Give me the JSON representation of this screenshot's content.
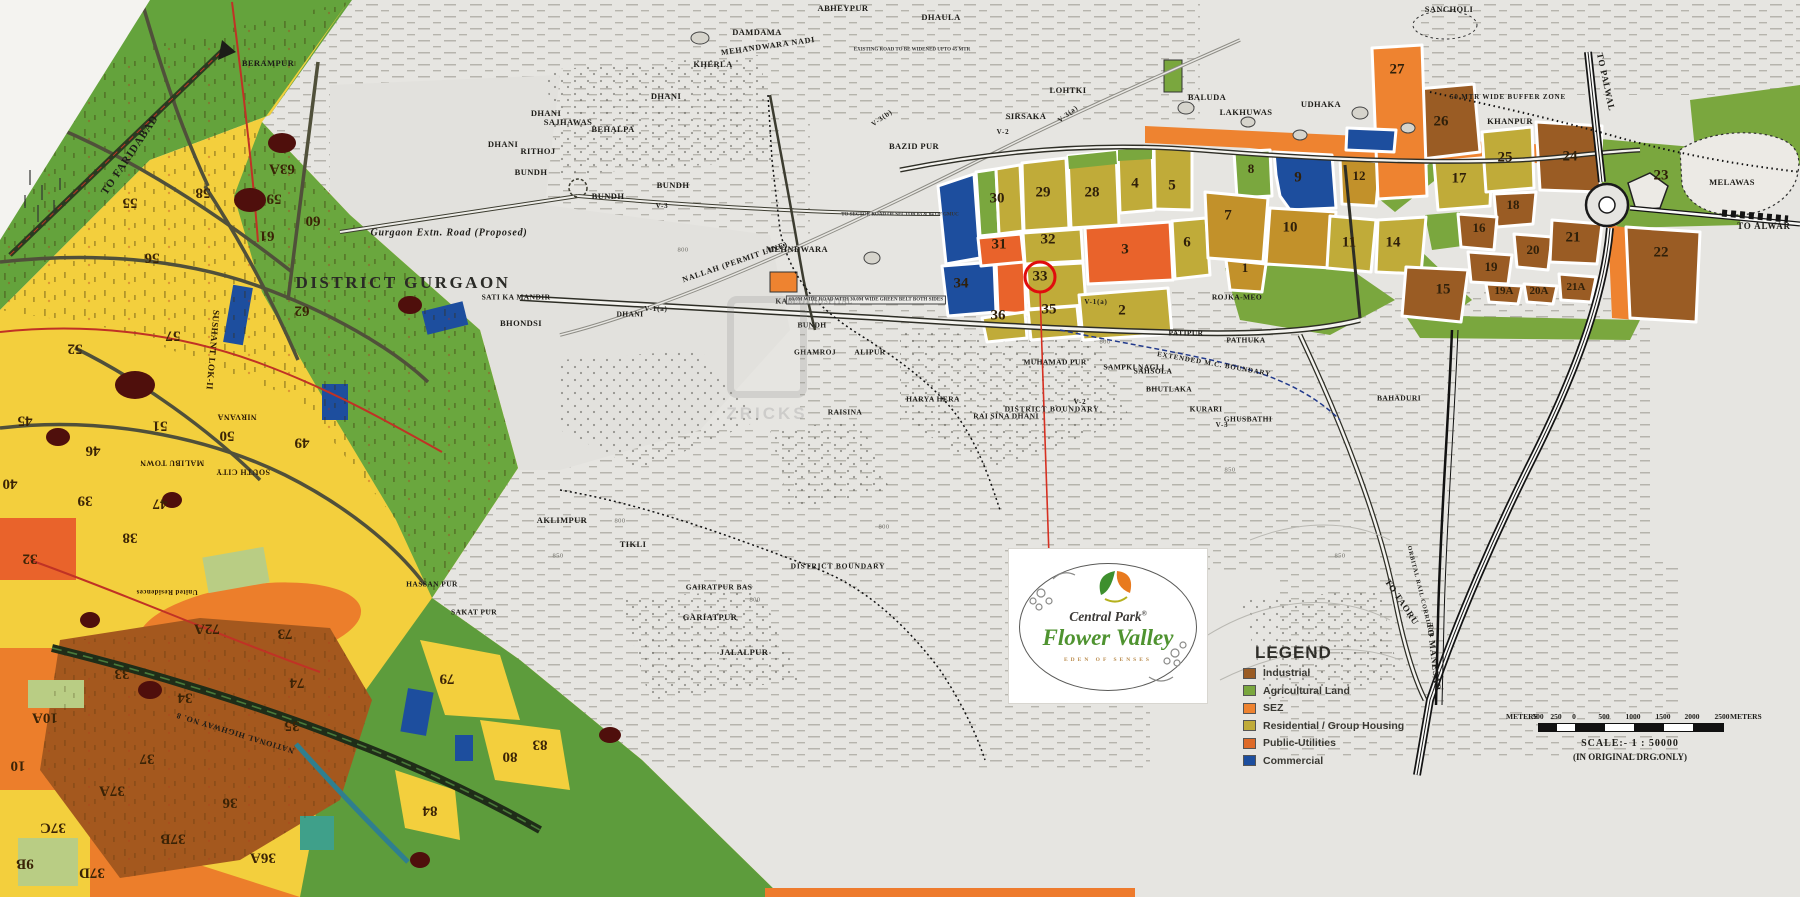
{
  "map_title": "DISTRICT GURGAON",
  "watermark": {
    "text": "ZRICKS"
  },
  "legend": {
    "title": "LEGEND",
    "items": [
      {
        "label": "Industrial",
        "color": "#9a5c24"
      },
      {
        "label": "Agricultural Land",
        "color": "#7aa73e"
      },
      {
        "label": "SEZ",
        "color": "#ee8330"
      },
      {
        "label": "Residential / Group Housing",
        "color": "#c0ab39"
      },
      {
        "label": "Public-Utilities",
        "color": "#de6a28"
      },
      {
        "label": "Commercial",
        "color": "#1d4e9e"
      }
    ]
  },
  "logo": {
    "brand": "Central Park",
    "reg": "®",
    "name": "Flower Valley",
    "tagline": "EDEN OF SENSES"
  },
  "scale_bar": {
    "meters_left": "METERS",
    "meters_right": "METERS",
    "ticks": [
      "500",
      "250",
      "0",
      "500",
      "1000",
      "1500",
      "2000",
      "2500"
    ],
    "tick_x": [
      0,
      18,
      36,
      66,
      95,
      125,
      154,
      184
    ],
    "scale_text": "SCALE:-  1 : 50000",
    "note": "(IN ORIGINAL DRG.ONLY)"
  },
  "boundaries": [
    {
      "t": "DISTRICT GURGAON",
      "x": 403,
      "y": 283,
      "big": true
    },
    {
      "t": "Gurgaon Extn. Road (Proposed)",
      "x": 449,
      "y": 233,
      "fs": 10,
      "ital": true
    },
    {
      "t": "DISTRICT BOUNDARY",
      "x": 1052,
      "y": 409,
      "fs": 7.5
    },
    {
      "t": "DISTRICT BOUNDARY",
      "x": 838,
      "y": 566,
      "fs": 7.5
    },
    {
      "t": "EXTENDED M.C. BOUNDARY",
      "x": 1214,
      "y": 364,
      "fs": 7,
      "r": 10
    },
    {
      "t": "50 MTR WIDE BUFFER ZONE",
      "x": 1508,
      "y": 97,
      "fs": 7
    }
  ],
  "villages": [
    {
      "t": "BERAMPUR",
      "x": 268,
      "y": 63
    },
    {
      "t": "DHANI",
      "x": 666,
      "y": 96
    },
    {
      "t": "KHERLA",
      "x": 713,
      "y": 64
    },
    {
      "t": "DAMDAMA",
      "x": 757,
      "y": 32
    },
    {
      "t": "ABHEYPUR",
      "x": 843,
      "y": 8
    },
    {
      "t": "DHAULA",
      "x": 941,
      "y": 17
    },
    {
      "t": "SANCHOLI",
      "x": 1449,
      "y": 9
    },
    {
      "t": "LOHTKI",
      "x": 1068,
      "y": 90
    },
    {
      "t": "SIRSAKA",
      "x": 1026,
      "y": 116
    },
    {
      "t": "BAZID PUR",
      "x": 914,
      "y": 146
    },
    {
      "t": "DHANI",
      "x": 546,
      "y": 113
    },
    {
      "t": "SAJHAWAS",
      "x": 568,
      "y": 122
    },
    {
      "t": "BEHALPA",
      "x": 613,
      "y": 129
    },
    {
      "t": "RITHOJ",
      "x": 538,
      "y": 151
    },
    {
      "t": "DHANI",
      "x": 503,
      "y": 144
    },
    {
      "t": "BUNDH",
      "x": 531,
      "y": 172
    },
    {
      "t": "BUNDH",
      "x": 608,
      "y": 196
    },
    {
      "t": "BUNDH",
      "x": 673,
      "y": 185
    },
    {
      "t": "MEHNDWARA",
      "x": 797,
      "y": 249
    },
    {
      "t": "KABLIJI HOSPITAL",
      "x": 814,
      "y": 301,
      "fs": 7.5
    },
    {
      "t": "BUNDH",
      "x": 812,
      "y": 325,
      "fs": 7.5
    },
    {
      "t": "DHANI",
      "x": 630,
      "y": 314,
      "fs": 7.5
    },
    {
      "t": "SATI KA MANDIR",
      "x": 516,
      "y": 297,
      "fs": 7.5
    },
    {
      "t": "BHONDSI",
      "x": 521,
      "y": 323
    },
    {
      "t": "GHAMROJ",
      "x": 815,
      "y": 352,
      "fs": 7.5
    },
    {
      "t": "ALIPUR",
      "x": 870,
      "y": 352,
      "fs": 7.5
    },
    {
      "t": "HARYA HERA",
      "x": 933,
      "y": 399,
      "fs": 7.5
    },
    {
      "t": "RAI SINA DHANI",
      "x": 1006,
      "y": 416,
      "fs": 7.5
    },
    {
      "t": "RAISINA",
      "x": 845,
      "y": 412,
      "fs": 7.5
    },
    {
      "t": "MUHAMAD PUR",
      "x": 1055,
      "y": 362,
      "fs": 7.5
    },
    {
      "t": "SAMPKI NAGLI",
      "x": 1134,
      "y": 367,
      "fs": 7.5
    },
    {
      "t": "AKLIMPUR",
      "x": 562,
      "y": 520
    },
    {
      "t": "TIKLI",
      "x": 633,
      "y": 544
    },
    {
      "t": "GAIRATPUR BAS",
      "x": 719,
      "y": 587,
      "fs": 7.5
    },
    {
      "t": "GARIATPUR",
      "x": 710,
      "y": 617
    },
    {
      "t": "JALALPUR",
      "x": 744,
      "y": 652
    },
    {
      "t": "HASSAN PUR",
      "x": 432,
      "y": 584,
      "fs": 7.5
    },
    {
      "t": "SAKAT PUR",
      "x": 474,
      "y": 612,
      "fs": 7.5
    },
    {
      "t": "BALUDA",
      "x": 1207,
      "y": 97
    },
    {
      "t": "LAKHUWAS",
      "x": 1246,
      "y": 112
    },
    {
      "t": "UDHAKA",
      "x": 1321,
      "y": 104
    },
    {
      "t": "KHANPUR",
      "x": 1510,
      "y": 121
    },
    {
      "t": "MELAWAS",
      "x": 1732,
      "y": 182
    },
    {
      "t": "ROJKA-MEO",
      "x": 1237,
      "y": 297,
      "fs": 7.5
    },
    {
      "t": "PATHUKA",
      "x": 1246,
      "y": 340,
      "fs": 7.5
    },
    {
      "t": "PATIPUR",
      "x": 1186,
      "y": 333,
      "fs": 7.5
    },
    {
      "t": "SAHSOLA",
      "x": 1153,
      "y": 371,
      "fs": 7.5
    },
    {
      "t": "BHUTLAKA",
      "x": 1169,
      "y": 389,
      "fs": 7.5
    },
    {
      "t": "KURARI",
      "x": 1206,
      "y": 409,
      "fs": 7.5
    },
    {
      "t": "GHUSBATHI",
      "x": 1248,
      "y": 419,
      "fs": 7.5
    },
    {
      "t": "BAHADURI",
      "x": 1399,
      "y": 398,
      "fs": 7.5
    }
  ],
  "road_labels": [
    {
      "t": "TO FARIDABAD",
      "x": 130,
      "y": 155,
      "r": -56,
      "fs": 11
    },
    {
      "t": "TO PALWAL",
      "x": 1606,
      "y": 82,
      "r": 78
    },
    {
      "t": "TO ALWAR",
      "x": 1764,
      "y": 226
    },
    {
      "t": "TO TAORU",
      "x": 1402,
      "y": 602,
      "r": 56
    },
    {
      "t": "TO MANESAR",
      "x": 1434,
      "y": 657,
      "r": 83
    },
    {
      "t": "ORBITAL RAIL CORRIDOR",
      "x": 1420,
      "y": 592,
      "r": 76,
      "fs": 6
    },
    {
      "t": "NALLAH (PERMIT LINE)",
      "x": 735,
      "y": 262,
      "r": -19,
      "fs": 8
    },
    {
      "t": "MEHANDWARA NADI",
      "x": 768,
      "y": 46,
      "r": -8,
      "fs": 8
    },
    {
      "t": "NATIONAL HIGHWAY NO. 8",
      "x": 235,
      "y": 733,
      "r": 197,
      "fs": 8
    },
    {
      "t": "V-3",
      "x": 662,
      "y": 206,
      "fs": 7
    },
    {
      "t": "V-2",
      "x": 1003,
      "y": 132,
      "fs": 7
    },
    {
      "t": "V-2",
      "x": 1080,
      "y": 402,
      "fs": 7
    },
    {
      "t": "V-3",
      "x": 1222,
      "y": 425,
      "fs": 7
    },
    {
      "t": "V-1(a)",
      "x": 656,
      "y": 309,
      "fs": 7
    },
    {
      "t": "V-1(a)",
      "x": 1096,
      "y": 302,
      "fs": 7
    },
    {
      "t": "V-3(b)",
      "x": 882,
      "y": 118,
      "r": -35,
      "fs": 7
    },
    {
      "t": "V-3(a)",
      "x": 1068,
      "y": 114,
      "r": -38,
      "fs": 7
    }
  ],
  "notes": [
    {
      "t": "EXISTING ROAD TO BE WIDENED UPTO 45 MTR",
      "x": 912,
      "y": 50
    },
    {
      "t": "TO SECTOR ROAD OF SECTOR 63 & 64 OF GMUC",
      "x": 900,
      "y": 215
    },
    {
      "t": "60.0M WIDE ROAD WITH 30.0M WIDE GREEN BELT BOTH SIDES",
      "x": 866,
      "y": 300,
      "boxed": true
    }
  ],
  "contours": [
    {
      "t": "800",
      "x": 683,
      "y": 250
    },
    {
      "t": "800",
      "x": 620,
      "y": 521
    },
    {
      "t": "850",
      "x": 558,
      "y": 556
    },
    {
      "t": "800",
      "x": 884,
      "y": 527
    },
    {
      "t": "800",
      "x": 1105,
      "y": 342
    },
    {
      "t": "850",
      "x": 1340,
      "y": 556
    },
    {
      "t": "850",
      "x": 1230,
      "y": 470
    },
    {
      "t": "800",
      "x": 755,
      "y": 600
    }
  ],
  "sohna_sectors": [
    {
      "n": "30",
      "x": 997,
      "y": 199
    },
    {
      "n": "29",
      "x": 1043,
      "y": 193
    },
    {
      "n": "28",
      "x": 1092,
      "y": 193
    },
    {
      "n": "4",
      "x": 1135,
      "y": 184
    },
    {
      "n": "5",
      "x": 1172,
      "y": 186
    },
    {
      "n": "31",
      "x": 999,
      "y": 245
    },
    {
      "n": "32",
      "x": 1048,
      "y": 240
    },
    {
      "n": "33",
      "x": 1040,
      "y": 277,
      "circled": true
    },
    {
      "n": "3",
      "x": 1125,
      "y": 250
    },
    {
      "n": "6",
      "x": 1187,
      "y": 243
    },
    {
      "n": "34",
      "x": 961,
      "y": 284
    },
    {
      "n": "36",
      "x": 998,
      "y": 316
    },
    {
      "n": "35",
      "x": 1049,
      "y": 310
    },
    {
      "n": "2",
      "x": 1122,
      "y": 311
    },
    {
      "n": "8",
      "x": 1251,
      "y": 169,
      "fs": 13
    },
    {
      "n": "9",
      "x": 1298,
      "y": 178
    },
    {
      "n": "7",
      "x": 1228,
      "y": 216
    },
    {
      "n": "10",
      "x": 1290,
      "y": 228
    },
    {
      "n": "1",
      "x": 1245,
      "y": 268,
      "fs": 13
    },
    {
      "n": "12",
      "x": 1359,
      "y": 176,
      "fs": 13
    },
    {
      "n": "27",
      "x": 1397,
      "y": 70
    },
    {
      "n": "26",
      "x": 1441,
      "y": 122
    },
    {
      "n": "25",
      "x": 1505,
      "y": 158
    },
    {
      "n": "24",
      "x": 1570,
      "y": 157
    },
    {
      "n": "23",
      "x": 1661,
      "y": 176
    },
    {
      "n": "17",
      "x": 1459,
      "y": 179
    },
    {
      "n": "18",
      "x": 1513,
      "y": 205,
      "fs": 13
    },
    {
      "n": "16",
      "x": 1479,
      "y": 228,
      "fs": 13
    },
    {
      "n": "20",
      "x": 1533,
      "y": 250,
      "fs": 13
    },
    {
      "n": "21",
      "x": 1573,
      "y": 238
    },
    {
      "n": "19",
      "x": 1491,
      "y": 267,
      "fs": 13
    },
    {
      "n": "19A",
      "x": 1504,
      "y": 291,
      "fs": 11
    },
    {
      "n": "20A",
      "x": 1539,
      "y": 291,
      "fs": 11
    },
    {
      "n": "21A",
      "x": 1576,
      "y": 287,
      "fs": 11
    },
    {
      "n": "15",
      "x": 1443,
      "y": 290
    },
    {
      "n": "22",
      "x": 1661,
      "y": 253
    },
    {
      "n": "14",
      "x": 1393,
      "y": 243
    },
    {
      "n": "11",
      "x": 1349,
      "y": 243
    }
  ],
  "left_map": {
    "numbers": [
      {
        "n": "55",
        "x": 130,
        "y": 202
      },
      {
        "n": "56",
        "x": 152,
        "y": 257
      },
      {
        "n": "57",
        "x": 173,
        "y": 335
      },
      {
        "n": "58",
        "x": 203,
        "y": 192
      },
      {
        "n": "59",
        "x": 274,
        "y": 198
      },
      {
        "n": "60",
        "x": 313,
        "y": 220
      },
      {
        "n": "61",
        "x": 267,
        "y": 235
      },
      {
        "n": "62",
        "x": 302,
        "y": 310
      },
      {
        "n": "63A",
        "x": 282,
        "y": 168
      },
      {
        "n": "52",
        "x": 75,
        "y": 348
      },
      {
        "n": "51",
        "x": 160,
        "y": 425
      },
      {
        "n": "50",
        "x": 227,
        "y": 435
      },
      {
        "n": "49",
        "x": 302,
        "y": 442
      },
      {
        "n": "45",
        "x": 25,
        "y": 420
      },
      {
        "n": "46",
        "x": 93,
        "y": 450
      },
      {
        "n": "47",
        "x": 160,
        "y": 503
      },
      {
        "n": "40",
        "x": 10,
        "y": 483
      },
      {
        "n": "39",
        "x": 85,
        "y": 500
      },
      {
        "n": "38",
        "x": 130,
        "y": 537
      },
      {
        "n": "32",
        "x": 30,
        "y": 558
      },
      {
        "n": "33",
        "x": 122,
        "y": 673
      },
      {
        "n": "34",
        "x": 185,
        "y": 697
      },
      {
        "n": "35",
        "x": 292,
        "y": 725
      },
      {
        "n": "36",
        "x": 230,
        "y": 802
      },
      {
        "n": "37",
        "x": 147,
        "y": 758
      },
      {
        "n": "37A",
        "x": 112,
        "y": 790
      },
      {
        "n": "37B",
        "x": 173,
        "y": 838
      },
      {
        "n": "36A",
        "x": 263,
        "y": 857
      },
      {
        "n": "37C",
        "x": 53,
        "y": 827
      },
      {
        "n": "37D",
        "x": 92,
        "y": 872
      },
      {
        "n": "9B",
        "x": 25,
        "y": 863
      },
      {
        "n": "10A",
        "x": 45,
        "y": 717
      },
      {
        "n": "10",
        "x": 18,
        "y": 765
      },
      {
        "n": "72A",
        "x": 207,
        "y": 628
      },
      {
        "n": "73",
        "x": 285,
        "y": 633
      },
      {
        "n": "74",
        "x": 297,
        "y": 682
      },
      {
        "n": "79",
        "x": 447,
        "y": 678
      },
      {
        "n": "80",
        "x": 510,
        "y": 756
      },
      {
        "n": "83",
        "x": 540,
        "y": 744
      },
      {
        "n": "84",
        "x": 430,
        "y": 810
      }
    ],
    "places": [
      {
        "t": "SUSHANT LOK-II",
        "x": 213,
        "y": 350,
        "r": 95,
        "fs": 9
      },
      {
        "t": "NIRVANA",
        "x": 237,
        "y": 417,
        "r": 180
      },
      {
        "t": "MALIBU TOWN",
        "x": 172,
        "y": 463,
        "r": 180
      },
      {
        "t": "SOUTH CITY",
        "x": 243,
        "y": 472,
        "r": 180
      },
      {
        "t": "United Residences",
        "x": 167,
        "y": 592,
        "r": 180,
        "fs": 7
      }
    ]
  }
}
